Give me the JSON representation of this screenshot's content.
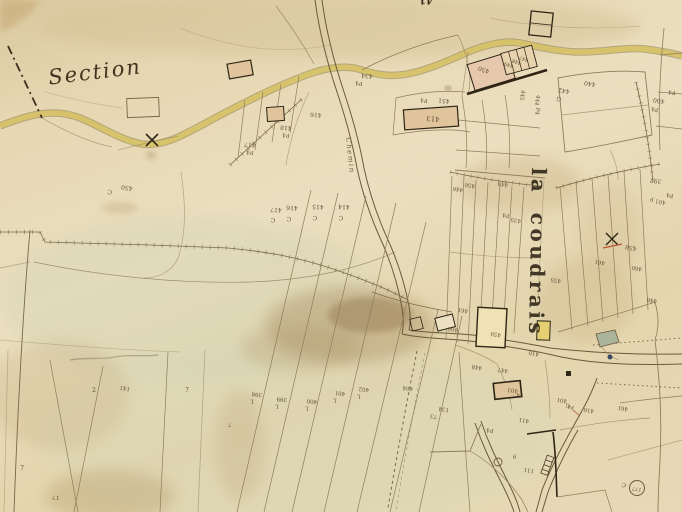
{
  "map": {
    "title": "Old cadastral map sheet",
    "section_label": "Section",
    "place_name": "la coudrais",
    "road_label": "Chemin",
    "edge_number": "41",
    "survey_point_number": "177",
    "palette": {
      "parchment": "#e6d8b4",
      "parchment_dark": "#d9c89e",
      "ink_dark": "#2e2516",
      "ink_mid": "#6b5a3c",
      "line_faint": "#97855f",
      "road_yellow": "#d8c35e",
      "building_beige": "#e0c49c",
      "building_pink": "#e6c9ad",
      "building_yellow": "#e4cf72",
      "pond_green": "#a9b398",
      "mark_red": "#b8512e",
      "dot_blue": "#3a4a66",
      "wash_green": "#ccd2b2",
      "stain_brown": "#9a7d50"
    },
    "labels": [
      {
        "t": "434",
        "x": 367,
        "y": 75,
        "r": 185,
        "s": 6
      },
      {
        "t": "P4",
        "x": 359,
        "y": 82,
        "r": 185,
        "s": 5.5
      },
      {
        "t": "P4",
        "x": 424,
        "y": 99,
        "r": 185,
        "s": 5.5
      },
      {
        "t": "451",
        "x": 444,
        "y": 100,
        "r": 185,
        "s": 6
      },
      {
        "t": "413",
        "x": 433,
        "y": 118,
        "r": 185,
        "s": 7
      },
      {
        "t": "418",
        "x": 286,
        "y": 127,
        "r": 185,
        "s": 6
      },
      {
        "t": "P4",
        "x": 286,
        "y": 134,
        "r": 185,
        "s": 5.5
      },
      {
        "t": "416",
        "x": 316,
        "y": 114,
        "r": 185,
        "s": 6
      },
      {
        "t": "417",
        "x": 250,
        "y": 144,
        "r": 185,
        "s": 6
      },
      {
        "t": "P4",
        "x": 250,
        "y": 151,
        "r": 185,
        "s": 5.5
      },
      {
        "t": "417",
        "x": 276,
        "y": 209,
        "r": 183,
        "s": 6
      },
      {
        "t": "C",
        "x": 273,
        "y": 219,
        "r": 183,
        "s": 6
      },
      {
        "t": "416",
        "x": 292,
        "y": 207,
        "r": 183,
        "s": 6
      },
      {
        "t": "C",
        "x": 289,
        "y": 218,
        "r": 183,
        "s": 6
      },
      {
        "t": "415",
        "x": 318,
        "y": 206,
        "r": 183,
        "s": 6
      },
      {
        "t": "C",
        "x": 315,
        "y": 217,
        "r": 183,
        "s": 6
      },
      {
        "t": "414",
        "x": 344,
        "y": 206,
        "r": 183,
        "s": 6
      },
      {
        "t": "C",
        "x": 341,
        "y": 217,
        "r": 183,
        "s": 6
      },
      {
        "t": "450",
        "x": 127,
        "y": 187,
        "r": 190,
        "s": 6
      },
      {
        "t": "C",
        "x": 110,
        "y": 191,
        "r": 190,
        "s": 6
      },
      {
        "t": "450",
        "x": 484,
        "y": 69,
        "r": 200,
        "s": 6
      },
      {
        "t": "449",
        "x": 509,
        "y": 64,
        "r": 200,
        "s": 5
      },
      {
        "t": "448",
        "x": 517,
        "y": 61,
        "r": 200,
        "s": 5
      },
      {
        "t": "447",
        "x": 524,
        "y": 58,
        "r": 200,
        "s": 5
      },
      {
        "t": "445",
        "x": 521,
        "y": 95,
        "r": 100,
        "s": 5.5
      },
      {
        "t": "444",
        "x": 536,
        "y": 100,
        "r": 100,
        "s": 5.5
      },
      {
        "t": "P4",
        "x": 536,
        "y": 111,
        "r": 100,
        "s": 5.5
      },
      {
        "t": "442",
        "x": 564,
        "y": 90,
        "r": 190,
        "s": 6
      },
      {
        "t": "G",
        "x": 559,
        "y": 98,
        "r": 190,
        "s": 6
      },
      {
        "t": "440",
        "x": 590,
        "y": 83,
        "r": 190,
        "s": 6
      },
      {
        "t": "400",
        "x": 659,
        "y": 100,
        "r": 190,
        "s": 6
      },
      {
        "t": "P4",
        "x": 655,
        "y": 108,
        "r": 190,
        "s": 5.5
      },
      {
        "t": "P4",
        "x": 672,
        "y": 91,
        "r": 185,
        "s": 5.5
      },
      {
        "t": "397",
        "x": 656,
        "y": 180,
        "r": 190,
        "s": 6
      },
      {
        "t": "446",
        "x": 458,
        "y": 188,
        "r": 190,
        "s": 5.5
      },
      {
        "t": "456",
        "x": 470,
        "y": 184,
        "r": 190,
        "s": 5.5
      },
      {
        "t": "449",
        "x": 503,
        "y": 183,
        "r": 190,
        "s": 5.5
      },
      {
        "t": "P4",
        "x": 506,
        "y": 214,
        "r": 190,
        "s": 5.5
      },
      {
        "t": "435",
        "x": 516,
        "y": 219,
        "r": 190,
        "s": 5.5
      },
      {
        "t": "401 p",
        "x": 658,
        "y": 200,
        "r": 190,
        "s": 5.5
      },
      {
        "t": "P4",
        "x": 670,
        "y": 194,
        "r": 190,
        "s": 5.5
      },
      {
        "t": "458",
        "x": 631,
        "y": 247,
        "r": 190,
        "s": 6
      },
      {
        "t": "461",
        "x": 600,
        "y": 261,
        "r": 190,
        "s": 5.5
      },
      {
        "t": "460",
        "x": 637,
        "y": 267,
        "r": 190,
        "s": 5.5
      },
      {
        "t": "446",
        "x": 652,
        "y": 299,
        "r": 190,
        "s": 5.5
      },
      {
        "t": "455",
        "x": 556,
        "y": 279,
        "r": 190,
        "s": 5.5
      },
      {
        "t": "461",
        "x": 463,
        "y": 309,
        "r": 190,
        "s": 5.5
      },
      {
        "t": "460",
        "x": 453,
        "y": 328,
        "r": 190,
        "s": 5.5
      },
      {
        "t": "459",
        "x": 496,
        "y": 333,
        "r": 190,
        "s": 5.5
      },
      {
        "t": "410",
        "x": 534,
        "y": 352,
        "r": 190,
        "s": 5.5
      },
      {
        "t": "403",
        "x": 513,
        "y": 389,
        "r": 190,
        "s": 5.5
      },
      {
        "t": "P4",
        "x": 520,
        "y": 394,
        "r": 190,
        "s": 5
      },
      {
        "t": "401",
        "x": 562,
        "y": 399,
        "r": 190,
        "s": 5.5
      },
      {
        "t": "G",
        "x": 568,
        "y": 404,
        "r": 190,
        "s": 5.5
      },
      {
        "t": "448",
        "x": 477,
        "y": 366,
        "r": 190,
        "s": 5.5
      },
      {
        "t": "447",
        "x": 503,
        "y": 369,
        "r": 190,
        "s": 5.5
      },
      {
        "t": "411",
        "x": 524,
        "y": 419,
        "r": 190,
        "s": 5.5
      },
      {
        "t": "416",
        "x": 589,
        "y": 409,
        "r": 190,
        "s": 5.5
      },
      {
        "t": "P4",
        "x": 571,
        "y": 406,
        "r": 190,
        "s": 5
      },
      {
        "t": "134",
        "x": 444,
        "y": 408,
        "r": 190,
        "s": 5.5
      },
      {
        "t": "73",
        "x": 434,
        "y": 415,
        "r": 190,
        "s": 5.5
      },
      {
        "t": "461",
        "x": 623,
        "y": 407,
        "r": 190,
        "s": 5.5
      },
      {
        "t": "111",
        "x": 529,
        "y": 469,
        "r": 190,
        "s": 5.5
      },
      {
        "t": "9",
        "x": 515,
        "y": 455,
        "r": 190,
        "s": 5.5
      },
      {
        "t": "P4",
        "x": 490,
        "y": 429,
        "r": 185,
        "s": 5.5
      },
      {
        "t": "C",
        "x": 624,
        "y": 484,
        "r": 190,
        "s": 6
      },
      {
        "t": "177",
        "x": 637,
        "y": 488,
        "r": 190,
        "s": 5
      },
      {
        "t": "398",
        "x": 257,
        "y": 393,
        "r": 185,
        "s": 5.5
      },
      {
        "t": "L",
        "x": 252,
        "y": 400,
        "r": 185,
        "s": 5.5
      },
      {
        "t": "399",
        "x": 282,
        "y": 398,
        "r": 185,
        "s": 5.5
      },
      {
        "t": "L",
        "x": 277,
        "y": 405,
        "r": 185,
        "s": 5.5
      },
      {
        "t": "400",
        "x": 312,
        "y": 400,
        "r": 185,
        "s": 5.5
      },
      {
        "t": "L",
        "x": 307,
        "y": 407,
        "r": 185,
        "s": 5.5
      },
      {
        "t": "401",
        "x": 340,
        "y": 392,
        "r": 185,
        "s": 5.5
      },
      {
        "t": "L",
        "x": 335,
        "y": 399,
        "r": 185,
        "s": 5.5
      },
      {
        "t": "402",
        "x": 364,
        "y": 388,
        "r": 185,
        "s": 5.5
      },
      {
        "t": "L",
        "x": 359,
        "y": 395,
        "r": 185,
        "s": 5.5
      },
      {
        "t": "404",
        "x": 408,
        "y": 387,
        "r": 185,
        "s": 5.5
      },
      {
        "t": "7",
        "x": 230,
        "y": 423,
        "r": 185,
        "s": 5.5
      },
      {
        "t": "7",
        "x": 22,
        "y": 469,
        "r": 0,
        "s": 6
      },
      {
        "t": "17",
        "x": 56,
        "y": 496,
        "r": 190,
        "s": 5.5
      },
      {
        "t": "2",
        "x": 94,
        "y": 391,
        "r": 0,
        "s": 6
      },
      {
        "t": "141",
        "x": 125,
        "y": 387,
        "r": 190,
        "s": 5.5
      },
      {
        "t": "7",
        "x": 187,
        "y": 391,
        "r": 0,
        "s": 6
      }
    ]
  }
}
